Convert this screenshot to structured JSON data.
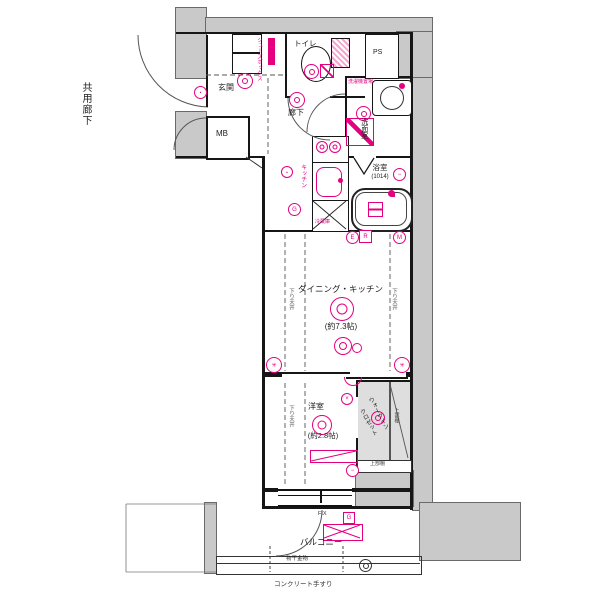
{
  "title": "マンション間取り図",
  "colors": {
    "pink": "#e4007f",
    "concrete": "#c9c9c9",
    "wall": "#161616",
    "closet_fill": "#dedede"
  },
  "labels": {
    "common_corridor": "共用廊下",
    "entrance": "玄関",
    "meter_box": "MB",
    "shoe_box": "シューズボックス",
    "toilet": "トイレ",
    "pipe_space": "PS",
    "hallway": "廊下",
    "washroom": "洗面室",
    "laundry_space": "洗濯機置場",
    "bathroom": "浴室",
    "bathroom_size": "(1014)",
    "kitchen": "キッチン",
    "refrigerator": "冷蔵庫",
    "dining_kitchen": "ダイニング・キッチン",
    "dining_kitchen_size": "(約7.3帖)",
    "lowered_ceiling": "下り天井",
    "western_room": "洋室",
    "western_room_size": "(約2.8帖)",
    "walk_in_closet_line1": "ウォークイン",
    "walk_in_closet_line2": "クロゼット",
    "upper_shelf": "上部棚",
    "balcony": "バルコニー",
    "laundry_hardware": "物干金物",
    "concrete_handrail": "コンクリート手すり",
    "fixed_window": "FIX"
  },
  "symbols": {
    "water_heater": "G",
    "gas": "G",
    "exhaust": "E",
    "range": "R",
    "meter": "M"
  }
}
